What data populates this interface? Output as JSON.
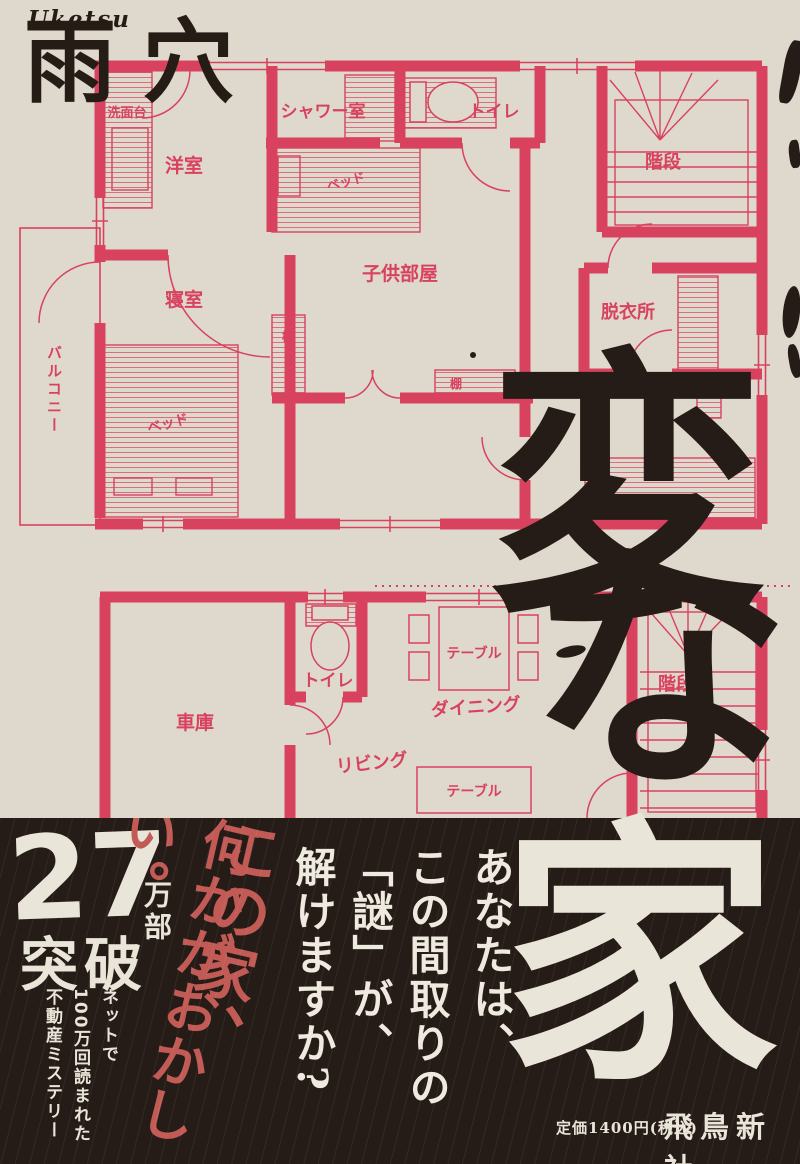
{
  "colors": {
    "background": "#DED9CC",
    "plan_line": "#D8425F",
    "ink_black": "#251C17",
    "band_background": "#251C17",
    "band_red": "#C25B56",
    "band_cream": "#EAE5D9"
  },
  "author": {
    "romaji": "Uketsu",
    "name": "雨穴"
  },
  "title": {
    "char1": "変",
    "char2": "な",
    "char3": "家"
  },
  "upper_plan": {
    "washstand": "洗面台",
    "western_room": "洋室",
    "shower_room": "シャワー室",
    "toilet": "トイレ",
    "stairs": "階段",
    "kids_room": "子供部屋",
    "bedroom": "寝室",
    "dressing_room": "脱衣所",
    "balcony": "バルコニー",
    "bed1": "ベッド",
    "bed2": "ベッド",
    "shelf1": "棚",
    "shelf2": "棚"
  },
  "lower_plan": {
    "garage": "車庫",
    "toilet": "トイレ",
    "dining": "ダイニング",
    "living": "リビング",
    "stairs": "階段",
    "table1": "テーブル",
    "table2": "テーブル"
  },
  "band": {
    "copies_number": "27",
    "copies_unit": "万部",
    "copies_verb": "突破",
    "tagline_1": "ネットで",
    "tagline_2": "100万回読まれた",
    "tagline_3": "不動産ミステリー",
    "catch_1": "この家、",
    "catch_2": "何かがおかしい。",
    "question_1": "あなたは、",
    "question_2": "この間取りの",
    "question_3": "「謎」が、",
    "question_4": "解けますか?",
    "price": "定価1400円(税込)",
    "publisher": "飛鳥新社"
  }
}
